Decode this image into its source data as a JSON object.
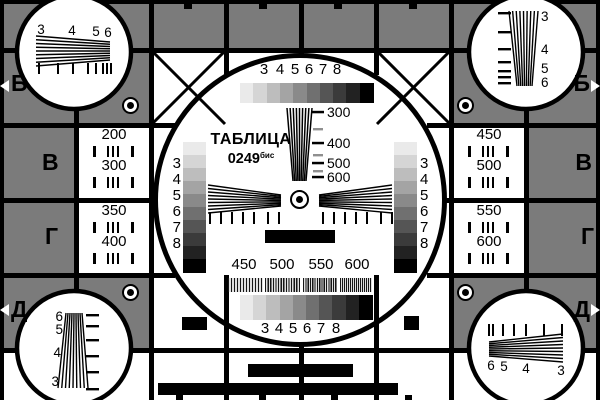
{
  "card": {
    "title": "ТАБЛИЦА",
    "code": "0249",
    "code_suffix": "бис"
  },
  "edge_letters": {
    "top_left": "Б",
    "top_right": "Б",
    "mid_left_upper": "В",
    "mid_right_upper": "В",
    "mid_left_lower": "Г",
    "mid_right_lower": "Г",
    "bottom_left": "Д",
    "bottom_right": "Д"
  },
  "gray_scale_labels": [
    "3",
    "4",
    "5",
    "6",
    "7",
    "8"
  ],
  "center_wedge_ticks": [
    "300",
    "400",
    "500",
    "600"
  ],
  "left_squares": {
    "r1": "200",
    "r2": "300",
    "r3": "350",
    "r4": "400"
  },
  "right_squares": {
    "r1": "450",
    "r2": "500",
    "r3": "550",
    "r4": "600"
  },
  "burst_labels": [
    "450",
    "500",
    "550",
    "600"
  ],
  "corner_wedge_labels": {
    "top_left": [
      "3",
      "4",
      "5",
      "6"
    ],
    "top_right": [
      "3",
      "4",
      "5",
      "6"
    ],
    "bottom_left": [
      "6",
      "5",
      "4",
      "3"
    ],
    "bottom_right": [
      "6",
      "5",
      "4",
      "3"
    ]
  },
  "colors": {
    "background_gray": "#7b7b7b",
    "line_black": "#000000",
    "white": "#ffffff",
    "tick_gray": "#8f8f8f",
    "gray_steps": [
      "#eaeaea",
      "#d5d5d5",
      "#bdbdbd",
      "#a4a4a4",
      "#8a8a8a",
      "#707070",
      "#555555",
      "#3b3b3b",
      "#222222",
      "#000000"
    ],
    "burst_dark": "#161616",
    "burst_light": "#dedede"
  }
}
